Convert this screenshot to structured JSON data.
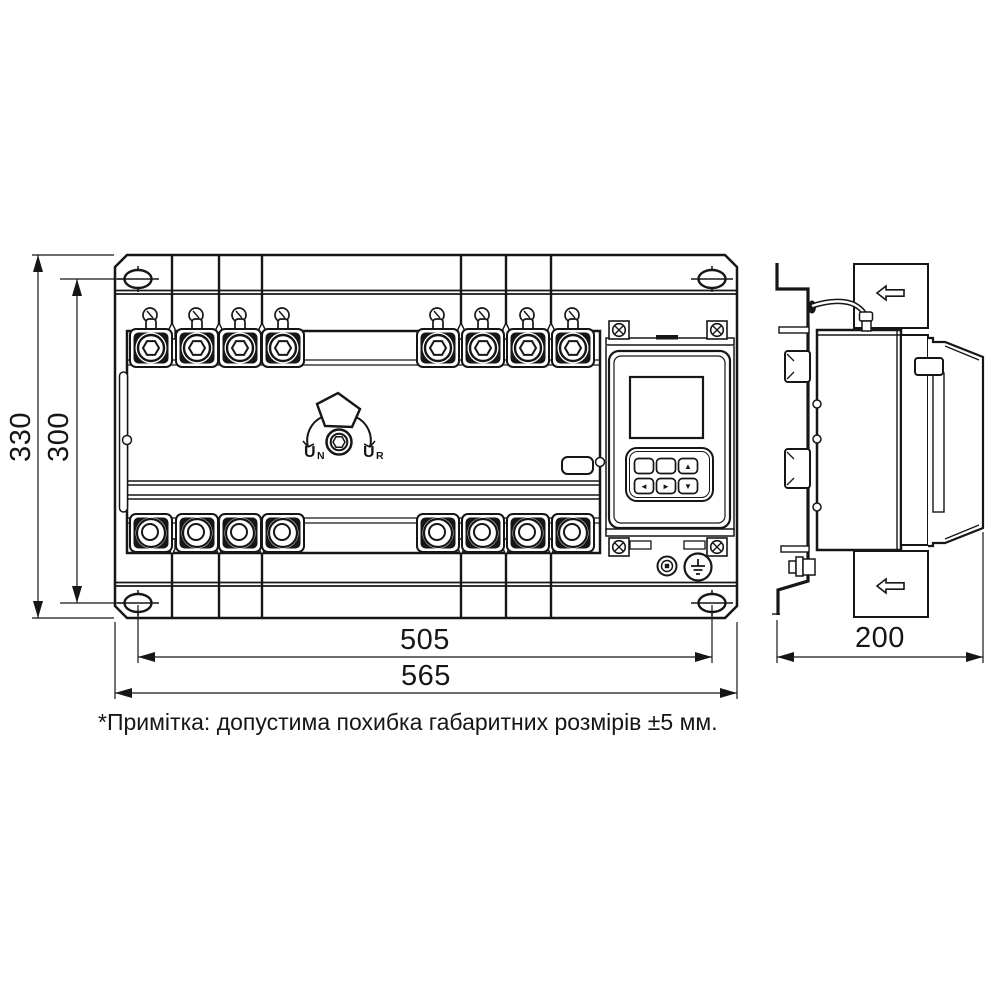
{
  "drawing": {
    "colors": {
      "ink": "#161616",
      "paper": "#ffffff"
    },
    "front_view": {
      "dims": {
        "height_overall": "330",
        "height_holes": "300",
        "width_holes": "505",
        "width_overall": "565"
      },
      "knob": {
        "left_main": "U",
        "left_sub": "N",
        "right_main": "U",
        "right_sub": "R"
      }
    },
    "side_view": {
      "dims": {
        "depth": "200"
      }
    },
    "module": {
      "keypad": [
        "",
        "",
        "▲",
        "◄",
        "►",
        "▼"
      ]
    },
    "icons": {
      "mounting_hole": "ellipse-crosshair",
      "terminal": "hex-bolt-terminal",
      "rotary_handle": "pentagon-knob",
      "flow_arrow": "left-outline-arrow",
      "ground_terminal": "earth-symbol",
      "screw": "phillips-screw"
    },
    "footnote": "*Примітка: допустима похибка габаритних розмірів ±5 мм."
  }
}
